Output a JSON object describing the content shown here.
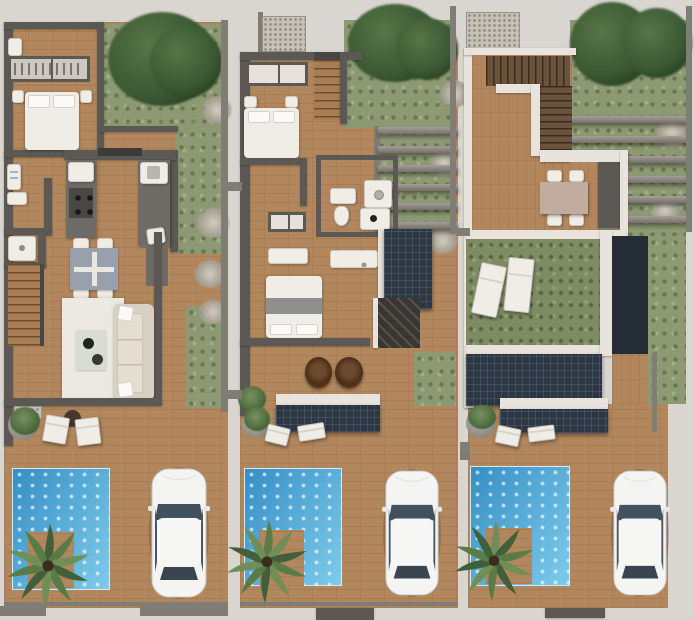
{
  "scene": {
    "type": "architectural floor plan render",
    "view": "top-down",
    "description": "Three side-by-side top-down renders of one narrow villa lot: ground floor, upper floor and roof terrace. Each lot strip ends in a rear terrace with plunge pool, corner timber deck, palm tree and a white car parked on a plank driveway.",
    "panel_count": 3,
    "visible_text": ""
  },
  "panels": [
    {
      "id": "ground-floor",
      "label": "Ground floor plan",
      "features": [
        "entry hall",
        "hanger wardrobe",
        "double bedroom with nightstands",
        "laundry bathroom with washer and basin",
        "shower room",
        "galley kitchen with cooktop island and sink counter",
        "square dining table with four chairs",
        "straight staircase",
        "living room with rug, coffee table and sofa",
        "side garden with trees and shrubs",
        "terrace with two lounge chairs and round side table",
        "potted plant",
        "plunge pool with corner deck",
        "palm tree",
        "white car on driveway"
      ]
    },
    {
      "id": "upper-floor",
      "label": "Upper floor plan",
      "features": [
        "stair flight",
        "shelf wardrobe",
        "bedroom one with nightstands",
        "family bathroom with shower, tub, toilet and basin",
        "double vanity",
        "bedroom two with dark blanket",
        "balcony with two wicker hanging chairs",
        "louvered dark canopy with loungers below",
        "solar panel",
        "rear garden under pergola slats",
        "side grass strip",
        "potted plant",
        "plunge pool with corner deck",
        "palm tree",
        "white car on driveway"
      ]
    },
    {
      "id": "roof-terrace",
      "label": "Roof terrace plan",
      "features": [
        "L-shaped stair with white parapet rails",
        "timber roof deck",
        "outdoor dining table with four chairs",
        "planted green roof with two sun loungers",
        "stair bulkhead",
        "solar panel array",
        "louvered dark canopy with loungers below",
        "rear garden under pergola slats",
        "potted plant",
        "plunge pool with corner deck",
        "palm tree",
        "white car on driveway"
      ]
    }
  ],
  "palette": {
    "bg": "#d9d5d0",
    "wall_dark": "#5c5854",
    "wall_mid": "#807c76",
    "white_wall": "#e8e4dd",
    "wood": "#b2875e",
    "wood_dark": "#9c744e",
    "grass": "#8c9972",
    "grass_dark": "#7e8c64",
    "tree": "#3c5a34",
    "pool_light": "#7ecbeb",
    "pool_dark": "#358fc4",
    "solar": "#2d3643",
    "slat": "#94908a",
    "furn_white": "#f0ede7",
    "sofa": "#d8d0c2",
    "rug": "#ece9e2",
    "table_gray": "#98a0ab",
    "table_taupe": "#c2aca0",
    "papasan": "#553517",
    "glass": "#43505d",
    "car_body": "#f4f4f2",
    "gravel": "#c7c2b8",
    "palm1": "#41603a",
    "palm2": "#5a7a46",
    "palm3": "#708e55",
    "trunk": "#3a2d1f"
  }
}
